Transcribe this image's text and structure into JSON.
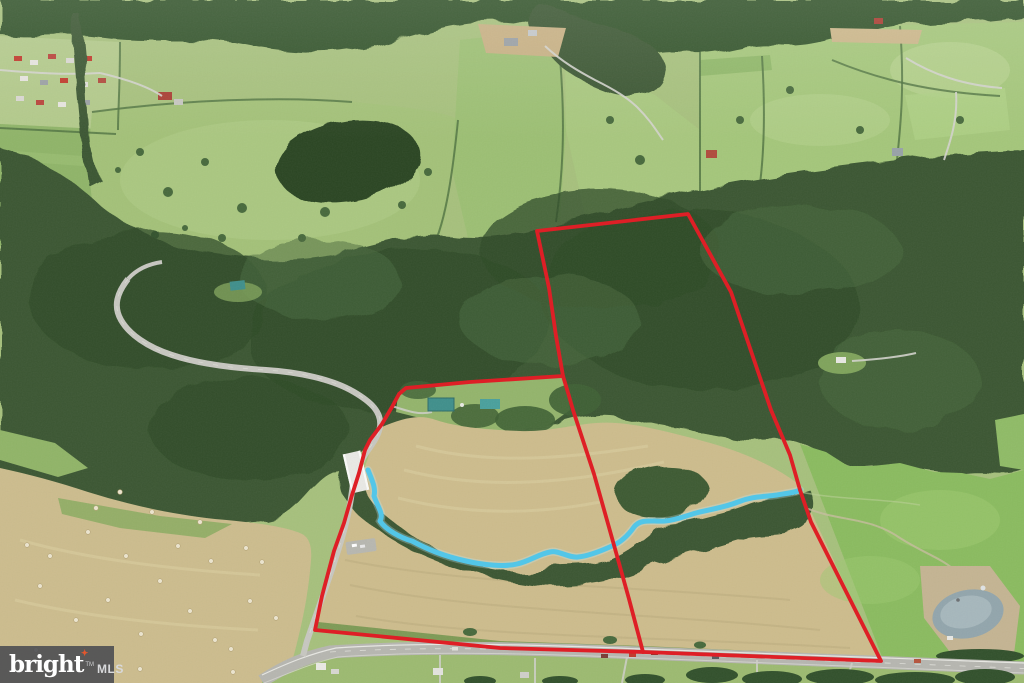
{
  "watermark": {
    "brand": "bright",
    "trademark": "TM",
    "suffix": "MLS",
    "spark_glyph": "✦",
    "bg_color": "#4d4e52",
    "text_color": "#ffffff",
    "suffix_color": "#d8d9db",
    "accent_color": "#e2572e"
  },
  "annotations": {
    "boundary_color": "#de1f26",
    "stream_color": "#53c6e8",
    "outer_boundary_points": "537,231 688,214 731,292 771,410 790,455 800,490 811,522 881,661 643,652 500,648 315,630 322,596 334,551 344,523 352,495 359,473 365,450 370,440 382,424 392,407 399,394 406,388 470,382 563,376 556,336 549,288 541,250",
    "divider_points": "563,376 569,396 573,410 594,474 612,538 629,599 643,652",
    "stream_path": "M368,470 C372,480 376,488 374,496 C378,508 384,514 380,521 C386,530 401,538 412,541 C427,549 443,556 466,561 C483,565 504,567 517,564 C530,561 539,554 550,552 C559,550 568,558 578,557 C589,556 601,551 612,546 C619,543 627,537 634,527 C641,518 653,522 665,521 C677,520 685,516 696,513 C711,509 723,508 738,502 C753,496 763,497 777,495 C789,493 797,492 800,490"
  }
}
